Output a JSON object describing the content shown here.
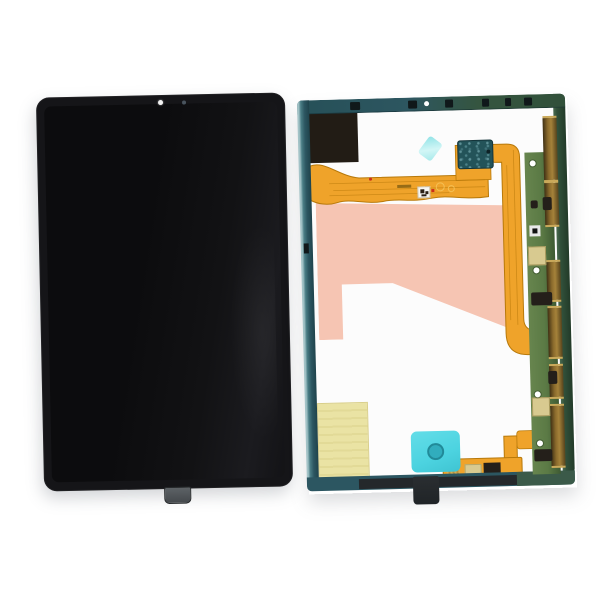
{
  "scene": {
    "kind": "product-photo",
    "subject": "tablet-lcd-screen-assembly-front-and-back"
  },
  "colors": {
    "page_bg": "#ffffff",
    "front_body": "#151518",
    "front_screen": "#0e0e10",
    "front_tab": "#565b5f",
    "camera_dot": "#f2f2f2",
    "sensor_dot": "#49545e",
    "frame_teal": "#2c5661",
    "frame_teal_light": "#a3c3c7",
    "frame_olive": "#31503a",
    "interior_white": "#fcfcfc",
    "rail_dark": "#24282b",
    "black_module": "#221c15",
    "pink_film": "#f6c5b3",
    "yellow_sticker": "#eae3a4",
    "cyan_diamond": "#a5e9ea",
    "cyan_pad": "#4cd3e0",
    "cyan_pad_circle": "#31adbd",
    "flex_orange": "#efa32a",
    "flex_dark": "#b8790a",
    "flex_light": "#f6c75f",
    "connector_teal": "#235359",
    "pcb_green": "#5b7a45",
    "pcb_green_dark": "#3e5a33",
    "bronze": "#8a6a2c",
    "bronze_dark": "#57431c",
    "bronze_light": "#caa95a",
    "pad_khaki": "#d8ca90",
    "chip_black": "#241f1a",
    "tab_black": "#202427",
    "gold_stub": "#d3af55",
    "label_white": "#f7f7f4",
    "red_mark": "#cc2d1a"
  },
  "back_panel": {
    "bronze_segments": [
      {
        "y": 22,
        "h": 62
      },
      {
        "y": 87,
        "h": 42
      },
      {
        "y": 166,
        "h": 38
      },
      {
        "y": 212,
        "h": 49
      },
      {
        "y": 270,
        "h": 31
      },
      {
        "y": 310,
        "h": 60
      }
    ],
    "top_rail_marks": [
      {
        "x": 53,
        "w": 10
      },
      {
        "x": 111,
        "w": 9
      },
      {
        "x": 148,
        "w": 8
      },
      {
        "x": 185,
        "w": 7
      },
      {
        "x": 208,
        "w": 6
      },
      {
        "x": 227,
        "w": 8
      }
    ],
    "pcb_chips": [
      {
        "x": 229,
        "y": 198,
        "w": 21,
        "h": 13
      },
      {
        "x": 231,
        "y": 106,
        "w": 7,
        "h": 8
      },
      {
        "x": 243,
        "y": 103,
        "w": 9,
        "h": 13
      },
      {
        "x": 244,
        "y": 277,
        "w": 9,
        "h": 13
      },
      {
        "x": 228,
        "y": 355,
        "w": 18,
        "h": 12
      }
    ],
    "pcb_pads": [
      {
        "x": 227,
        "y": 152,
        "w": 16,
        "h": 17
      },
      {
        "x": 227,
        "y": 303,
        "w": 16,
        "h": 17
      }
    ],
    "pcb_holes": [
      {
        "x": 231,
        "y": 66
      },
      {
        "x": 232,
        "y": 173
      },
      {
        "x": 230,
        "y": 297
      },
      {
        "x": 231,
        "y": 346
      }
    ]
  }
}
